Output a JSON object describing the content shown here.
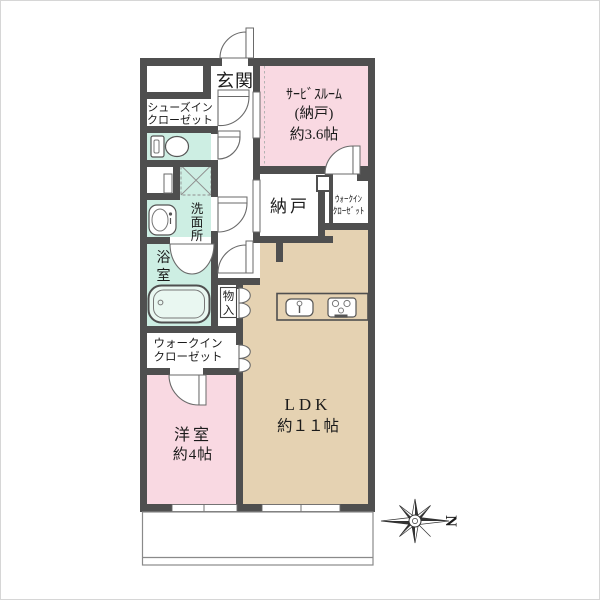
{
  "image_type": "apartment-floor-plan",
  "colors": {
    "wall": "#4f4f4f",
    "room_pink": "#f9d9e2",
    "room_mint": "#cdeee3",
    "room_tan": "#e5d2b2",
    "text": "#1b1b1b",
    "balcony_line": "#8a8a8a"
  },
  "rooms": {
    "genkan": {
      "label": "玄関"
    },
    "shoes_closet": {
      "line1": "シューズイン",
      "line2": "クローゼット"
    },
    "service_room": {
      "line1": "ｻｰﾋﾞｽﾙｰﾑ",
      "line2": "(納戸)",
      "line3": "約3.6帖"
    },
    "nando": {
      "label": "納戸"
    },
    "wic_right": {
      "line1": "ｳｫｰｸｲﾝ",
      "line2": "ｸﾛｰｾﾞｯﾄ"
    },
    "senmenjo": {
      "chars": [
        "洗",
        "面",
        "所"
      ]
    },
    "yokushitsu": {
      "chars": [
        "浴",
        "室"
      ]
    },
    "monoire": {
      "chars": [
        "物",
        "入"
      ]
    },
    "wic_left": {
      "line1": "ウォークイン",
      "line2": "クローゼット"
    },
    "yoshitsu": {
      "line1": "洋室",
      "line2": "約4帖"
    },
    "ldk": {
      "line1": "LDK",
      "line2": "約１１帖"
    }
  },
  "compass": {
    "north_label": "N"
  }
}
